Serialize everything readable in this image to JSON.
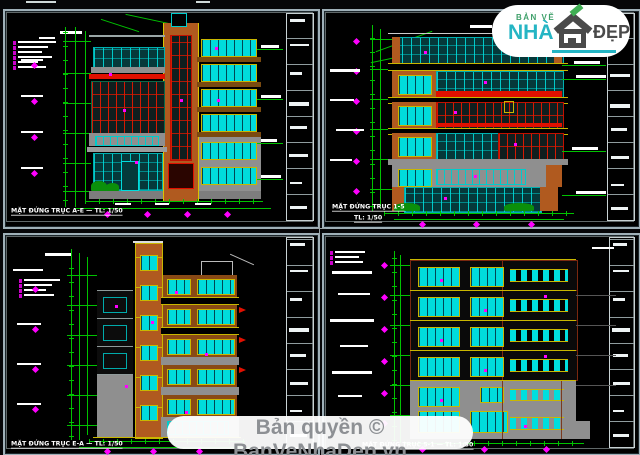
{
  "panels": {
    "top_left": {
      "caption": "MẶT ĐỨNG TRỤC A-E — TL: 1/50"
    },
    "top_right": {
      "caption": "MẶT ĐỨNG TRỤC 1-5",
      "scale": "TL: 1/50"
    },
    "bottom_left": {
      "caption": "MẶT ĐỨNG TRỤC E-A — TL: 1/50"
    },
    "bottom_right": {
      "caption": "MẶT ĐỨNG TRỤC 5-1 — TL: 1/50"
    }
  },
  "watermark": {
    "brand_top": "BẢN VẼ",
    "brand_main": "NHÀ",
    "brand_suffix": "ĐẸP"
  },
  "banner": {
    "text": "Bản quyền © BanVeNhaDep.vn"
  },
  "palette": {
    "background": "#000000",
    "panel_border": "#9fb0b8",
    "dimension_green": "#00c200",
    "marker_magenta": "#ff00ff",
    "window_cyan": "#00dcdc",
    "frame_yellow": "#c9b700",
    "pier_orange": "#b05a1f",
    "band_red": "#e01000",
    "wall_gray": "#8f8f8f",
    "text_white": "#ffffff",
    "logo_green": "#3fa06a",
    "logo_teal": "#25b5c4",
    "logo_gray": "#4a4a4a",
    "banner_text": "#8d9094"
  }
}
